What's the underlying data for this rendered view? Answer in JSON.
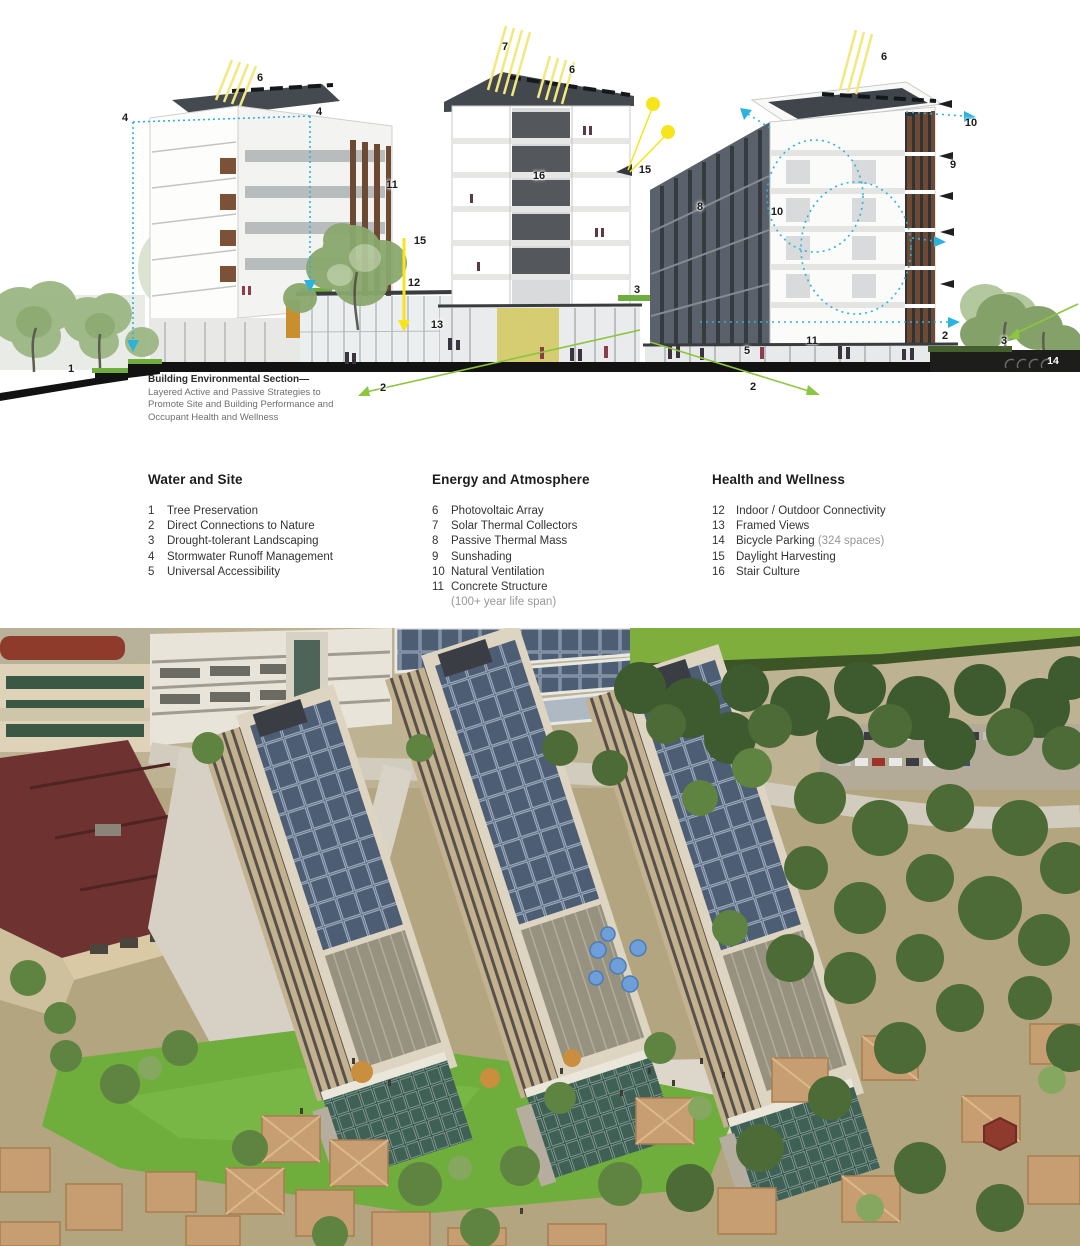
{
  "section_diagram": {
    "caption": {
      "title": "Building Environmental Section—",
      "lines": [
        "Layered Active and Passive Strategies to",
        "Promote Site and Building Performance and",
        "Occupant Health and Wellness"
      ]
    },
    "colors": {
      "sun_yellow": "#f6e51c",
      "vent_blue": "#2bb3e0",
      "nature_green": "#8cc63e",
      "ink": "#231f20"
    },
    "markers": [
      {
        "num": "6",
        "x": 260,
        "y": 78
      },
      {
        "num": "4",
        "x": 125,
        "y": 118
      },
      {
        "num": "4",
        "x": 319,
        "y": 112
      },
      {
        "num": "11",
        "x": 392,
        "y": 185
      },
      {
        "num": "15",
        "x": 420,
        "y": 241
      },
      {
        "num": "12",
        "x": 414,
        "y": 283
      },
      {
        "num": "13",
        "x": 437,
        "y": 325
      },
      {
        "num": "1",
        "x": 71,
        "y": 369
      },
      {
        "num": "2",
        "x": 383,
        "y": 388
      },
      {
        "num": "7",
        "x": 505,
        "y": 47
      },
      {
        "num": "6",
        "x": 572,
        "y": 70
      },
      {
        "num": "16",
        "x": 539,
        "y": 176
      },
      {
        "num": "15",
        "x": 645,
        "y": 170
      },
      {
        "num": "3",
        "x": 637,
        "y": 290
      },
      {
        "num": "6",
        "x": 884,
        "y": 57
      },
      {
        "num": "10",
        "x": 971,
        "y": 123
      },
      {
        "num": "9",
        "x": 953,
        "y": 165
      },
      {
        "num": "8",
        "x": 700,
        "y": 207
      },
      {
        "num": "10",
        "x": 777,
        "y": 212
      },
      {
        "num": "11",
        "x": 812,
        "y": 341
      },
      {
        "num": "5",
        "x": 747,
        "y": 351
      },
      {
        "num": "2",
        "x": 753,
        "y": 387
      },
      {
        "num": "2",
        "x": 945,
        "y": 336
      },
      {
        "num": "3",
        "x": 1004,
        "y": 341
      },
      {
        "num": "14",
        "x": 1053,
        "y": 361,
        "inverse": true
      }
    ]
  },
  "legend": {
    "columns": [
      {
        "heading": "Water and Site",
        "items": [
          {
            "num": "1",
            "label": "Tree Preservation"
          },
          {
            "num": "2",
            "label": "Direct Connections to Nature"
          },
          {
            "num": "3",
            "label": "Drought-tolerant Landscaping"
          },
          {
            "num": "4",
            "label": "Stormwater Runoff Management"
          },
          {
            "num": "5",
            "label": "Universal Accessibility"
          }
        ]
      },
      {
        "heading": "Energy and Atmosphere",
        "items": [
          {
            "num": "6",
            "label": "Photovoltaic Array"
          },
          {
            "num": "7",
            "label": "Solar Thermal Collectors"
          },
          {
            "num": "8",
            "label": "Passive Thermal Mass"
          },
          {
            "num": "9",
            "label": "Sunshading"
          },
          {
            "num": "10",
            "label": "Natural Ventilation"
          },
          {
            "num": "11",
            "label": "Concrete Structure",
            "note": "(100+ year life span)"
          }
        ]
      },
      {
        "heading": "Health and Wellness",
        "items": [
          {
            "num": "12",
            "label": "Indoor / Outdoor Connectivity"
          },
          {
            "num": "13",
            "label": "Framed Views"
          },
          {
            "num": "14",
            "label": "Bicycle Parking",
            "note_inline": "(324 spaces)"
          },
          {
            "num": "15",
            "label": "Daylight Harvesting"
          },
          {
            "num": "16",
            "label": "Stair Culture"
          }
        ]
      }
    ]
  },
  "aerial_photo": {
    "description": "Aerial photograph of three residential towers with sloped rooftop photovoltaic arrays, campus lawn and plaza, parking structure with solar canopies, playing field, parking lot, and surrounding low-rise housing among trees"
  }
}
